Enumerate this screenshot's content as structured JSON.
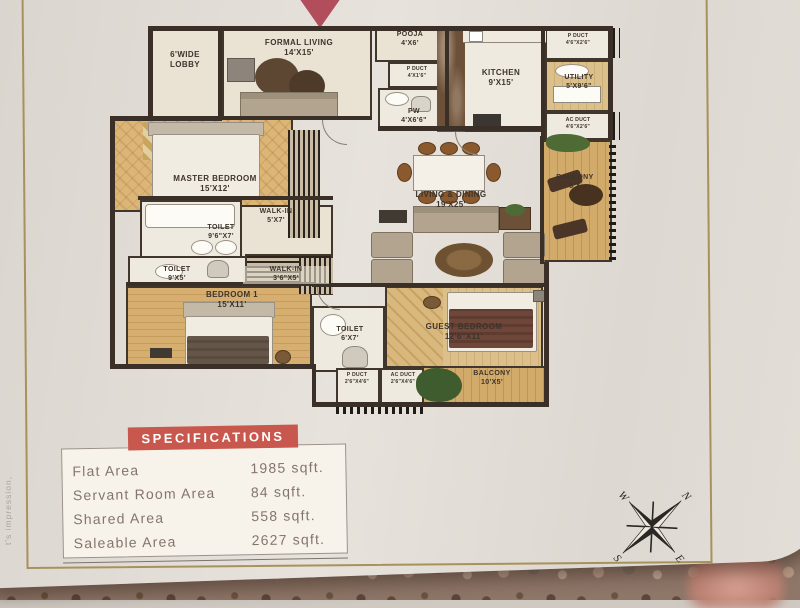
{
  "photo": {
    "side_text": "t's impression,"
  },
  "plan": {
    "rooms": [
      {
        "id": "lobby",
        "name": "6'WIDE LOBBY",
        "dim": ""
      },
      {
        "id": "formal-living",
        "name": "FORMAL LIVING",
        "dim": "14'X15'"
      },
      {
        "id": "pooja",
        "name": "POOJA",
        "dim": "4'X6'"
      },
      {
        "id": "p-duct-1",
        "name": "P DUCT",
        "dim": "4'X1'6\""
      },
      {
        "id": "pw",
        "name": "PW",
        "dim": "4'X6'6\""
      },
      {
        "id": "kitchen",
        "name": "KITCHEN",
        "dim": "9'X15'"
      },
      {
        "id": "p-duct-2",
        "name": "P DUCT",
        "dim": "4'6\"X2'6\""
      },
      {
        "id": "utility",
        "name": "UTILITY",
        "dim": "5'X9'6\""
      },
      {
        "id": "ac-duct-1",
        "name": "AC DUCT",
        "dim": "4'6\"X2'6\""
      },
      {
        "id": "balcony-east",
        "name": "BALCONY",
        "dim": "5'X"
      },
      {
        "id": "master-bedroom",
        "name": "MASTER BEDROOM",
        "dim": "15'X12'"
      },
      {
        "id": "walk-in-1",
        "name": "WALK-IN",
        "dim": "5'X7'"
      },
      {
        "id": "toilet-master",
        "name": "TOILET",
        "dim": "9'6\"X7'"
      },
      {
        "id": "toilet-2",
        "name": "TOILET",
        "dim": "9'X5'"
      },
      {
        "id": "walk-in-2",
        "name": "WALK-IN",
        "dim": "3'6\"X5'"
      },
      {
        "id": "living-dining",
        "name": "LIVING & DINING",
        "dim": "19'X25'"
      },
      {
        "id": "bedroom-1",
        "name": "BEDROOM 1",
        "dim": "15'X11'"
      },
      {
        "id": "toilet-3",
        "name": "TOILET",
        "dim": "6'X7'"
      },
      {
        "id": "guest-bedroom",
        "name": "GUEST BEDROOM",
        "dim": "12'6\"X11'"
      },
      {
        "id": "balcony-south",
        "name": "BALCONY",
        "dim": "10'X5'"
      },
      {
        "id": "p-duct-3",
        "name": "P DUCT",
        "dim": "2'6\"X4'6\""
      },
      {
        "id": "ac-duct-2",
        "name": "AC DUCT",
        "dim": "2'6\"X4'6\""
      }
    ]
  },
  "specifications": {
    "title": "SPECIFICATIONS",
    "rows": [
      {
        "label": "Flat Area",
        "value": "1985 sqft."
      },
      {
        "label": "Servant Room Area",
        "value": "84 sqft."
      },
      {
        "label": "Shared Area",
        "value": "558 sqft."
      },
      {
        "label": "Saleable Area",
        "value": "2627 sqft."
      }
    ]
  },
  "compass": {
    "n": "N",
    "s": "S",
    "e": "E",
    "w": "W"
  },
  "colors": {
    "spec_header_red": "#c8574d",
    "gold_border": "#a7925c",
    "entry_arrow_red": "#b24d5c",
    "wall_dark": "#3b3027",
    "wood_tan": "#d4ad6e"
  }
}
